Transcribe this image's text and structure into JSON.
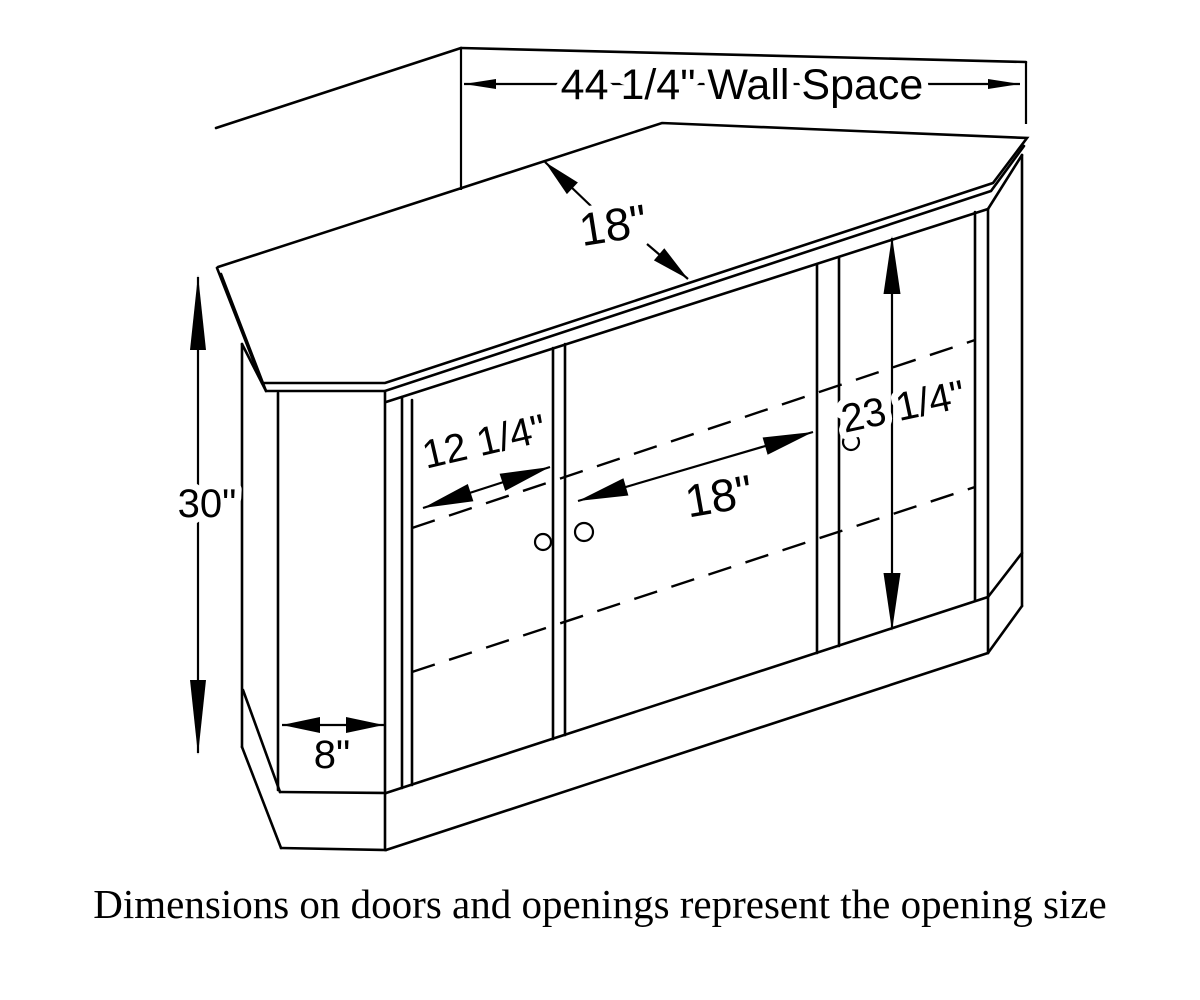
{
  "diagram": {
    "title_caption": "Dimensions on doors and openings represent the opening size",
    "dimensions": {
      "wall_space": "44 1/4\" Wall Space",
      "top_depth": "18\"",
      "left_door_opening": "12 1/4\"",
      "center_opening": "18\"",
      "right_door_opening": "23 1/4\"",
      "cabinet_height": "30\"",
      "side_panel_width": "8\""
    },
    "colors": {
      "line": "#000000",
      "background": "#ffffff"
    }
  }
}
